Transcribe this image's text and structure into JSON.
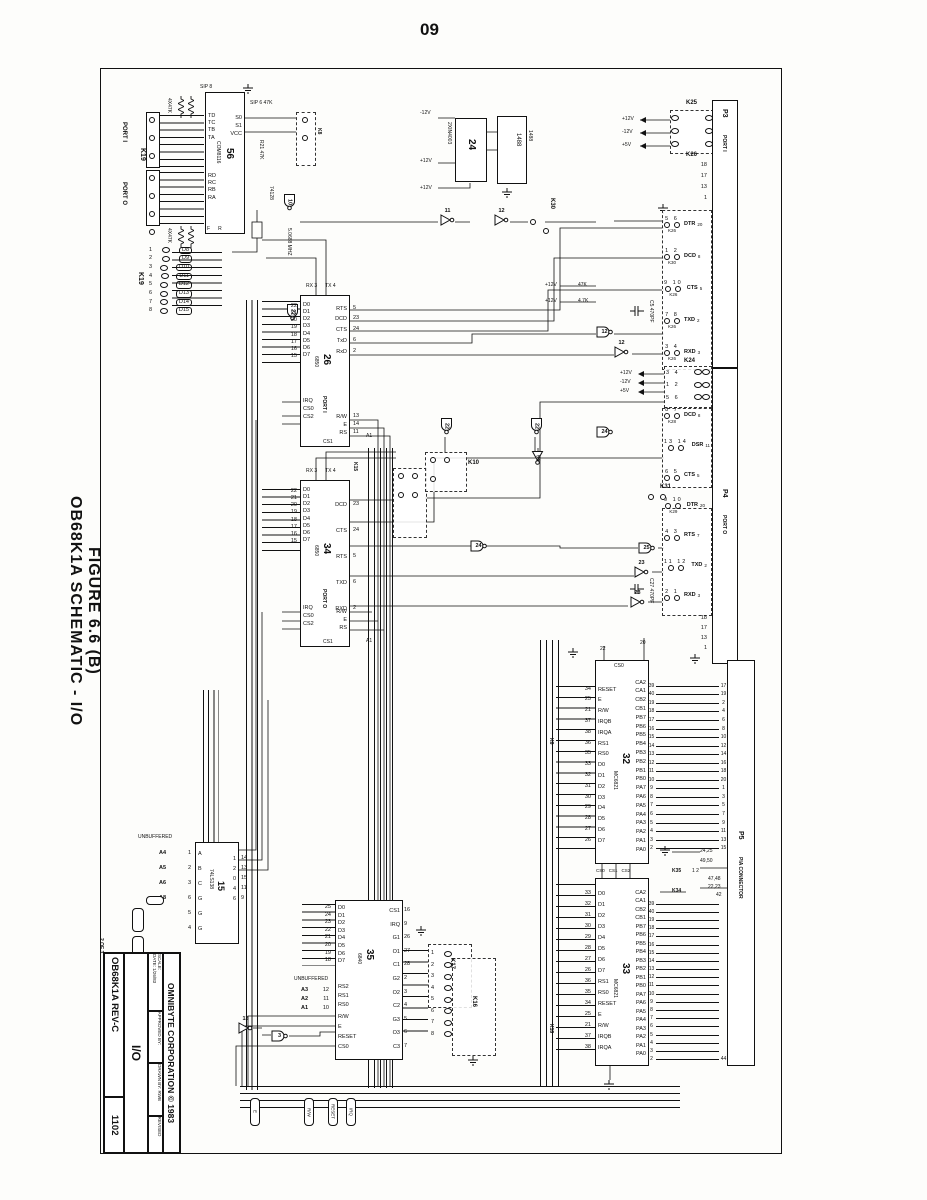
{
  "page": {
    "number": "09"
  },
  "side_title": {
    "line1": "OB68K1A SCHEMATIC - I/O",
    "line2": "FIGURE 6.6 (B)"
  },
  "title_block": {
    "sheet": "2 OF 3",
    "company": "OMNIBYTE CORPORATION © 1983",
    "scale": "SCALE:",
    "date": "DATE: 1/26/83",
    "approved": "APPROVED BY:",
    "drawn": "DRAWN BY: RWB",
    "revised": "REVISED",
    "subtitle": "I/O",
    "board": "OB68K1A  REV-C",
    "number": "1102"
  },
  "power": {
    "p12": "+12V",
    "n12": "-12V",
    "p5": "+5V"
  },
  "misc": {
    "xtal": "5.0688 MHZ",
    "r21": "R21 47K",
    "r47a": "47K",
    "r47b": "4.7K",
    "sip8": "SIP 8",
    "sip6": "SIP 6 47K",
    "res_a": "4X47K",
    "res_b": "4X47K",
    "in4003": "2XIN4003",
    "c5": "C5 470PF",
    "c27": "C27 470PF",
    "unbuf_a": "UNBUFFERED",
    "unbuf_b": "UNBUFFERED",
    "k6": "K6",
    "k8": "K8",
    "k10": "K10",
    "k15": "K15",
    "k16": "K16",
    "k17": "K17",
    "k18": "K18",
    "k24": "K24",
    "k25": "K25",
    "k26": "K26",
    "k28": "K28",
    "k29": "K29",
    "k30": "K30",
    "k31": "K31",
    "k34": "K34",
    "k35": "K35",
    "k35pins": "1 2",
    "gnd_a": "24,25",
    "gnd_b": "49,50",
    "n4748": "47,48",
    "n2223": "22,23",
    "n42": "42",
    "n44": "44",
    "pill1": "E",
    "pill2": "R/W",
    "pill3": "RESET",
    "pill4": "IRQ",
    "port_i": "PORT I",
    "port_o": "PORT O",
    "k19": "K19",
    "k19b": "K19",
    "g74128": "74128"
  },
  "connectors": {
    "p3": {
      "ref": "P3",
      "label": "PORT I",
      "gnd_pins": [
        "18",
        "17",
        "13",
        "1"
      ],
      "signals": [
        {
          "jpins": "5 6",
          "j": "K26",
          "name": "DTR",
          "pin": "20"
        },
        {
          "jpins": "1 2",
          "j": "K30",
          "name": "DCD",
          "pin": "8"
        },
        {
          "jpins": "9 10",
          "j": "K26",
          "name": "CTS",
          "pin": "5"
        },
        {
          "jpins": "7 8",
          "j": "K26",
          "name": "TXD",
          "pin": "2"
        },
        {
          "jpins": "3 4",
          "j": "K26",
          "name": "RXD",
          "pin": "3"
        }
      ]
    },
    "p4": {
      "ref": "P4",
      "label": "PORT O",
      "k24rows": [
        "3 4",
        "1 2",
        "5 6"
      ],
      "gnd_pins": [
        "18",
        "17",
        "13",
        "1"
      ],
      "signals": [
        {
          "jpins": "8 7",
          "j": "K28",
          "name": "DCD",
          "pin": "8"
        },
        {
          "jpins": "13 14",
          "j": "",
          "name": "DSR",
          "pin": "11"
        },
        {
          "jpins": "6 5",
          "j": "",
          "name": "CTS",
          "pin": "5"
        },
        {
          "jpins": "9 10",
          "j": "K29",
          "name": "DTR",
          "pin": "20"
        },
        {
          "jpins": "4 3",
          "j": "",
          "name": "RTS",
          "pin": "7"
        },
        {
          "jpins": "11 12",
          "j": "",
          "name": "TXD",
          "pin": "2"
        },
        {
          "jpins": "2 1",
          "j": "",
          "name": "RXD",
          "pin": "3"
        }
      ]
    },
    "p5": {
      "ref": "P5",
      "label": "PIA CONNECTOR",
      "upper": [
        {
          "l": "39",
          "r": "17"
        },
        {
          "l": "40",
          "r": "19"
        },
        {
          "l": "19",
          "r": "2"
        },
        {
          "l": "18",
          "r": "4"
        },
        {
          "l": "17",
          "r": "6"
        },
        {
          "l": "16",
          "r": "8"
        },
        {
          "l": "15",
          "r": "10"
        },
        {
          "l": "14",
          "r": "12"
        },
        {
          "l": "13",
          "r": "14"
        },
        {
          "l": "12",
          "r": "16"
        },
        {
          "l": "11",
          "r": "18"
        },
        {
          "l": "10",
          "r": "20"
        },
        {
          "l": "9",
          "r": "1"
        },
        {
          "l": "8",
          "r": "3"
        },
        {
          "l": "7",
          "r": "5"
        },
        {
          "l": "6",
          "r": "7"
        },
        {
          "l": "5",
          "r": "9"
        },
        {
          "l": "4",
          "r": "11"
        },
        {
          "l": "3",
          "r": "13"
        },
        {
          "l": "2",
          "r": "15"
        }
      ],
      "lower": [
        {
          "l": "39",
          "r": ""
        },
        {
          "l": "40",
          "r": ""
        },
        {
          "l": "19",
          "r": ""
        },
        {
          "l": "18",
          "r": ""
        },
        {
          "l": "17",
          "r": ""
        },
        {
          "l": "16",
          "r": ""
        },
        {
          "l": "15",
          "r": ""
        },
        {
          "l": "14",
          "r": ""
        },
        {
          "l": "13",
          "r": ""
        },
        {
          "l": "12",
          "r": ""
        },
        {
          "l": "11",
          "r": ""
        },
        {
          "l": "10",
          "r": ""
        },
        {
          "l": "9",
          "r": ""
        },
        {
          "l": "8",
          "r": ""
        },
        {
          "l": "7",
          "r": ""
        },
        {
          "l": "6",
          "r": ""
        },
        {
          "l": "5",
          "r": ""
        },
        {
          "l": "4",
          "r": ""
        },
        {
          "l": "3",
          "r": ""
        },
        {
          "l": "2",
          "r": "44"
        }
      ]
    },
    "k19": {
      "pins": [
        {
          "p": "1",
          "n": "D8"
        },
        {
          "p": "2",
          "n": "D9"
        },
        {
          "p": "3",
          "n": "D10"
        },
        {
          "p": "4",
          "n": "D11"
        },
        {
          "p": "5",
          "n": "D12"
        },
        {
          "p": "6",
          "n": "D13"
        },
        {
          "p": "7",
          "n": "D14"
        },
        {
          "p": "8",
          "n": "D15"
        }
      ]
    },
    "k17pins": [
      {
        "p": "1"
      },
      {
        "p": "2"
      },
      {
        "p": "3"
      },
      {
        "p": "4"
      },
      {
        "p": "5"
      },
      {
        "p": "6"
      },
      {
        "p": "7"
      },
      {
        "p": "8"
      }
    ]
  },
  "ics": {
    "ic56": {
      "ref": "56",
      "part": "COM8116",
      "t_pins": [
        {
          "n": "TD"
        },
        {
          "n": "TC"
        },
        {
          "n": "TB"
        },
        {
          "n": "TA"
        }
      ],
      "r_pins": [
        {
          "n": "RD"
        },
        {
          "n": "RC"
        },
        {
          "n": "RB"
        },
        {
          "n": "RA"
        }
      ],
      "right": [
        {
          "n": "S0"
        },
        {
          "n": "S1"
        },
        {
          "n": "VCC"
        }
      ],
      "bot": [
        {
          "n": "F"
        },
        {
          "n": "R"
        }
      ]
    },
    "ic26": {
      "ref": "26",
      "part": "6850",
      "port": "PORT I",
      "a1": "A1",
      "cs1": "CS1",
      "top": [
        {
          "n": "RX",
          "p": "3"
        },
        {
          "n": "TX",
          "p": "4"
        }
      ],
      "left": [
        {
          "p": "22",
          "n": "D0"
        },
        {
          "p": "21",
          "n": "D1"
        },
        {
          "p": "20",
          "n": "D2"
        },
        {
          "p": "19",
          "n": "D3"
        },
        {
          "p": "18",
          "n": "D4"
        },
        {
          "p": "17",
          "n": "D5"
        },
        {
          "p": "16",
          "n": "D6"
        },
        {
          "p": "15",
          "n": "D7"
        }
      ],
      "ctl": [
        {
          "p": "7",
          "n": "IRQ"
        },
        {
          "p": "8",
          "n": "CS0"
        },
        {
          "p": "9",
          "n": "CS2"
        }
      ],
      "right": [
        {
          "n": "RTS",
          "p": "5"
        },
        {
          "n": "DCD",
          "p": "23"
        },
        {
          "n": "CTS",
          "p": "24"
        },
        {
          "n": "TxD",
          "p": "6"
        },
        {
          "n": "RxD",
          "p": "2"
        }
      ],
      "rctl": [
        {
          "n": "R/W",
          "p": "13"
        },
        {
          "n": "E",
          "p": "14"
        },
        {
          "n": "RS",
          "p": "11"
        }
      ]
    },
    "ic34": {
      "ref": "34",
      "part": "6850",
      "port": "PORT O",
      "a1": "A1",
      "cs1": "CS1",
      "top": [
        {
          "n": "RX",
          "p": "3"
        },
        {
          "n": "TX",
          "p": "4"
        }
      ],
      "left": [
        {
          "p": "22",
          "n": "D0"
        },
        {
          "p": "21",
          "n": "D1"
        },
        {
          "p": "20",
          "n": "D2"
        },
        {
          "p": "19",
          "n": "D3"
        },
        {
          "p": "18",
          "n": "D4"
        },
        {
          "p": "17",
          "n": "D5"
        },
        {
          "p": "16",
          "n": "D6"
        },
        {
          "p": "15",
          "n": "D7"
        }
      ],
      "ctl": [
        {
          "p": "7",
          "n": "IRQ"
        },
        {
          "p": "8",
          "n": "CS0"
        },
        {
          "p": "9",
          "n": "CS2"
        }
      ],
      "right": [
        {
          "n": "DCD",
          "p": "23"
        },
        {
          "n": "CTS",
          "p": "24"
        },
        {
          "n": "RTS",
          "p": "5"
        },
        {
          "n": "TXD",
          "p": "6"
        },
        {
          "n": "RXD",
          "p": "2"
        }
      ],
      "rctl": [
        {
          "n": "R/W",
          "p": "13"
        },
        {
          "n": "E",
          "p": "14"
        },
        {
          "n": "RS",
          "p": "11"
        }
      ]
    },
    "ic32": {
      "ref": "32",
      "part": "MC6821",
      "cs0": "CS0",
      "p22": "22",
      "p20": "20",
      "left": [
        {
          "p": "34",
          "n": "RESET"
        },
        {
          "p": "25",
          "n": "E"
        },
        {
          "p": "21",
          "n": "R/W"
        },
        {
          "p": "37",
          "n": "IRQB"
        },
        {
          "p": "38",
          "n": "IRQA"
        },
        {
          "p": "36",
          "n": "RS1"
        },
        {
          "p": "35",
          "n": "RS0"
        },
        {
          "p": "33",
          "n": "D0"
        },
        {
          "p": "32",
          "n": "D1"
        },
        {
          "p": "31",
          "n": "D2"
        },
        {
          "p": "30",
          "n": "D3"
        },
        {
          "p": "29",
          "n": "D4"
        },
        {
          "p": "28",
          "n": "D5"
        },
        {
          "p": "27",
          "n": "D6"
        },
        {
          "p": "26",
          "n": "D7"
        }
      ],
      "right": [
        {
          "n": "CA2",
          "p": "39"
        },
        {
          "n": "CA1",
          "p": "40"
        },
        {
          "n": "CB2",
          "p": "19"
        },
        {
          "n": "CB1",
          "p": "18"
        },
        {
          "n": "PB7",
          "p": "17"
        },
        {
          "n": "PB6",
          "p": "16"
        },
        {
          "n": "PB5",
          "p": "15"
        },
        {
          "n": "PB4",
          "p": "14"
        },
        {
          "n": "PB3",
          "p": "13"
        },
        {
          "n": "PB2",
          "p": "12"
        },
        {
          "n": "PB1",
          "p": "11"
        },
        {
          "n": "PB0",
          "p": "10"
        },
        {
          "n": "PA7",
          "p": "9"
        },
        {
          "n": "PA6",
          "p": "8"
        },
        {
          "n": "PA5",
          "p": "7"
        },
        {
          "n": "PA4",
          "p": "6"
        },
        {
          "n": "PA3",
          "p": "5"
        },
        {
          "n": "PA2",
          "p": "4"
        },
        {
          "n": "PA1",
          "p": "3"
        },
        {
          "n": "PA0",
          "p": "2"
        }
      ]
    },
    "ic33": {
      "ref": "33",
      "part": "MC6821",
      "top": [
        {
          "n": "CS0",
          "p": "22"
        },
        {
          "n": "CS1",
          "p": "24"
        },
        {
          "n": "CS2",
          "p": "23"
        }
      ],
      "left": [
        {
          "p": "33",
          "n": "D0"
        },
        {
          "p": "32",
          "n": "D1"
        },
        {
          "p": "31",
          "n": "D2"
        },
        {
          "p": "30",
          "n": "D3"
        },
        {
          "p": "29",
          "n": "D4"
        },
        {
          "p": "28",
          "n": "D5"
        },
        {
          "p": "27",
          "n": "D6"
        },
        {
          "p": "26",
          "n": "D7"
        },
        {
          "p": "36",
          "n": "RS1"
        },
        {
          "p": "35",
          "n": "RS0"
        },
        {
          "p": "34",
          "n": "RESET"
        },
        {
          "p": "25",
          "n": "E"
        },
        {
          "p": "21",
          "n": "R/W"
        },
        {
          "p": "37",
          "n": "IRQB"
        },
        {
          "p": "38",
          "n": "IRQA"
        }
      ],
      "right": [
        {
          "n": "CA2",
          "p": "39"
        },
        {
          "n": "CA1",
          "p": "40"
        },
        {
          "n": "CB2",
          "p": "19"
        },
        {
          "n": "CB1",
          "p": "18"
        },
        {
          "n": "PB7",
          "p": "17"
        },
        {
          "n": "PB6",
          "p": "16"
        },
        {
          "n": "PB5",
          "p": "15"
        },
        {
          "n": "PB4",
          "p": "14"
        },
        {
          "n": "PB3",
          "p": "13"
        },
        {
          "n": "PB2",
          "p": "12"
        },
        {
          "n": "PB1",
          "p": "11"
        },
        {
          "n": "PB0",
          "p": "10"
        },
        {
          "n": "PA7",
          "p": "9"
        },
        {
          "n": "PA6",
          "p": "8"
        },
        {
          "n": "PA5",
          "p": "7"
        },
        {
          "n": "PA4",
          "p": "6"
        },
        {
          "n": "PA3",
          "p": "5"
        },
        {
          "n": "PA2",
          "p": "4"
        },
        {
          "n": "PA1",
          "p": "3"
        },
        {
          "n": "PA0",
          "p": "2"
        }
      ]
    },
    "ic35": {
      "ref": "35",
      "part": "6840",
      "left": [
        {
          "p": "25",
          "n": "D0"
        },
        {
          "p": "24",
          "n": "D1"
        },
        {
          "p": "23",
          "n": "D2"
        },
        {
          "p": "22",
          "n": "D3"
        },
        {
          "p": "21",
          "n": "D4"
        },
        {
          "p": "20",
          "n": "D5"
        },
        {
          "p": "19",
          "n": "D6"
        },
        {
          "p": "18",
          "n": "D7"
        }
      ],
      "adr": [
        {
          "a": "A3",
          "p": "12",
          "n": "RS2"
        },
        {
          "a": "A2",
          "p": "11",
          "n": "RS1"
        },
        {
          "a": "A1",
          "p": "10",
          "n": "RS0"
        }
      ],
      "ctl": [
        {
          "p": "13",
          "n": "R/W"
        },
        {
          "p": "17",
          "n": "E"
        },
        {
          "p": "8",
          "n": "RESET"
        },
        {
          "p": "15",
          "n": "CS0"
        }
      ],
      "right": [
        {
          "n": "CS1",
          "p": "16"
        },
        {
          "n": "IRQ",
          "p": "9"
        },
        {
          "n": "G1",
          "p": "26"
        },
        {
          "n": "O1",
          "p": "27"
        },
        {
          "n": "C1",
          "p": "28"
        },
        {
          "n": "G2",
          "p": "2"
        },
        {
          "n": "O2",
          "p": "3"
        },
        {
          "n": "C2",
          "p": "4"
        },
        {
          "n": "G3",
          "p": "5"
        },
        {
          "n": "O3",
          "p": "6"
        },
        {
          "n": "C3",
          "p": "7"
        }
      ]
    },
    "ic15": {
      "ref": "15",
      "part": "74LS138",
      "left": [
        {
          "net": "A4",
          "p": "1",
          "n": "A"
        },
        {
          "net": "A5",
          "p": "2",
          "n": "B"
        },
        {
          "net": "A6",
          "p": "3",
          "n": "C"
        },
        {
          "net": "A8",
          "p": "6",
          "n": "G"
        },
        {
          "net": "",
          "p": "5",
          "n": "G"
        },
        {
          "net": "",
          "p": "4",
          "n": "G"
        }
      ],
      "right": [
        {
          "n": "1",
          "p": "14"
        },
        {
          "n": "2",
          "p": "13"
        },
        {
          "n": "0",
          "p": "15"
        },
        {
          "n": "4",
          "p": "11"
        },
        {
          "n": "6",
          "p": "9"
        }
      ]
    },
    "ic24": {
      "ref": "24",
      "part": "1488"
    },
    "ic11": {
      "ref": "11",
      "part": "1488"
    }
  },
  "gates": [
    "10",
    "22",
    "22",
    "22",
    "24",
    "54",
    "11",
    "12",
    "12",
    "12",
    "24",
    "25",
    "23",
    "23",
    "3",
    "13"
  ]
}
